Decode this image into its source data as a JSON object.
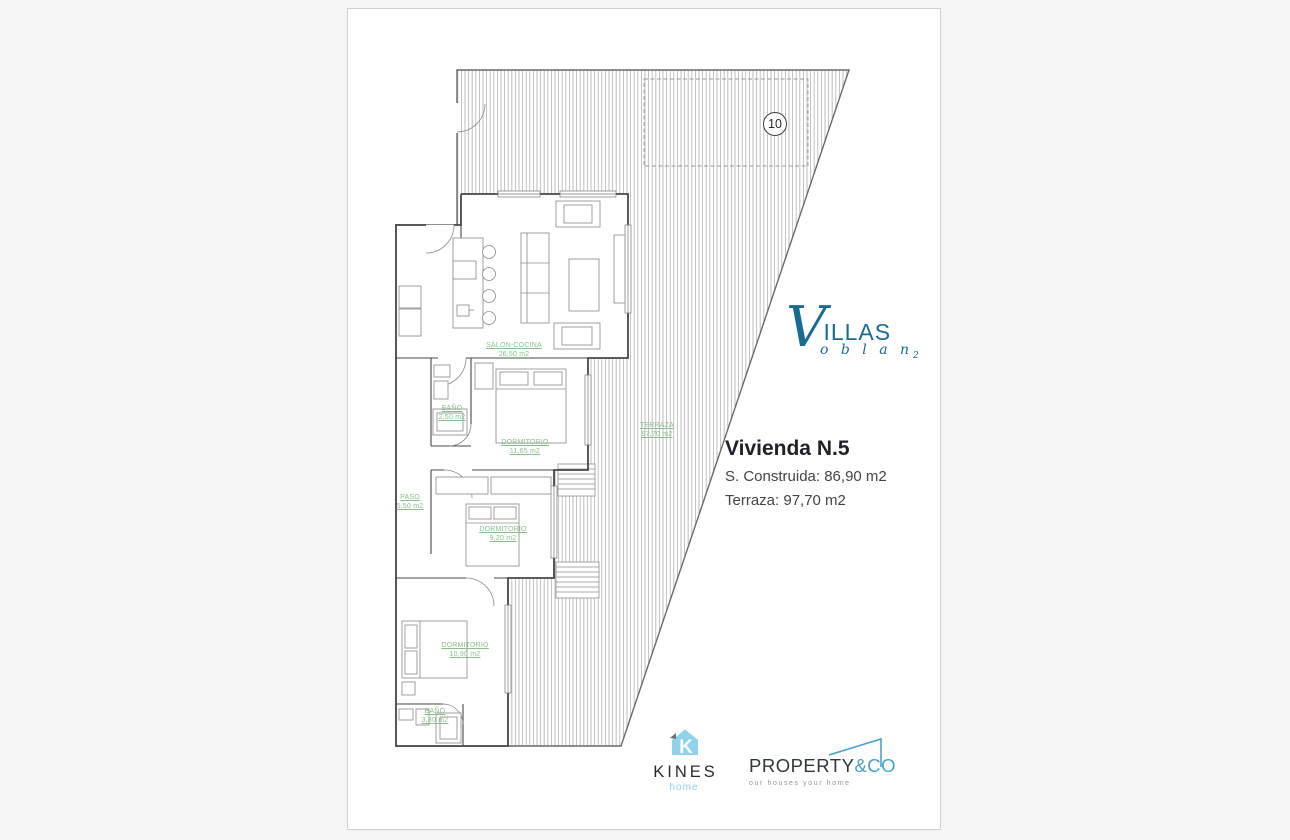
{
  "plan": {
    "plot_number": "10",
    "rooms": [
      {
        "name": "SALON-COCINA",
        "area": "26,50 m2"
      },
      {
        "name": "BAÑO",
        "area": "2,50 m2"
      },
      {
        "name": "DORMITORIO",
        "area": "11,65 m2"
      },
      {
        "name": "PASO",
        "area": "5,50 m2"
      },
      {
        "name": "DORMITORIO",
        "area": "9,20 m2"
      },
      {
        "name": "DORMITORIO",
        "area": "10,90 m2"
      },
      {
        "name": "BAÑO",
        "area": "3,30 m2"
      },
      {
        "name": "TERRAZA",
        "area": "97,70 m2"
      }
    ]
  },
  "listing": {
    "title": "Vivienda N.5",
    "built": "S. Construida: 86,90 m2",
    "terrace": "Terraza: 97,70 m2"
  },
  "branding": {
    "villas": {
      "v": "V",
      "name": "ILLAS",
      "sub": "o b l a n",
      "sub2": "2"
    },
    "kines": {
      "icon_letter": "K",
      "name": "KINES",
      "sub": "home"
    },
    "property": {
      "name": "PROPERTY",
      "suffix": "&CO",
      "tagline": "our houses your home"
    }
  },
  "colors": {
    "accent_blue": "#1a6b94",
    "light_blue": "#8ccfeb",
    "property_blue": "#4aa1c9",
    "label_green": "#8cbd8c",
    "wall_gray": "#474747",
    "hatch_gray": "#a6a6a6"
  }
}
